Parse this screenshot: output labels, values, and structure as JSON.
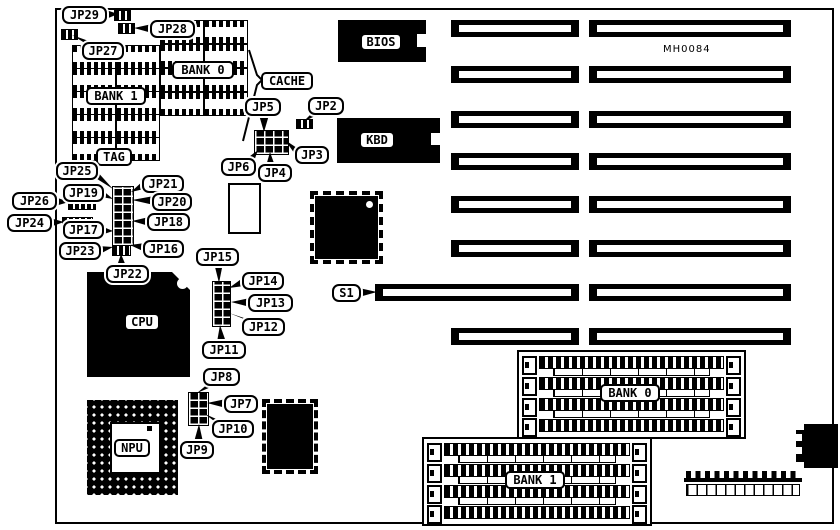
{
  "figure": {
    "kind": "motherboard jumper location diagram",
    "board_code": "MH0084"
  },
  "components": {
    "bios": "BIOS",
    "kbd": "KBD",
    "cpu": "CPU",
    "npu": "NPU",
    "tag": "TAG",
    "cache": "CACHE",
    "cache_bank0": "BANK 0",
    "cache_bank1": "BANK 1",
    "simm_bank0": "BANK 0",
    "simm_bank1": "BANK 1"
  },
  "callouts": {
    "jp2": "JP2",
    "jp3": "JP3",
    "jp4": "JP4",
    "jp5": "JP5",
    "jp6": "JP6",
    "jp7": "JP7",
    "jp8": "JP8",
    "jp9": "JP9",
    "jp10": "JP10",
    "jp11": "JP11",
    "jp12": "JP12",
    "jp13": "JP13",
    "jp14": "JP14",
    "jp15": "JP15",
    "jp16": "JP16",
    "jp17": "JP17",
    "jp18": "JP18",
    "jp19": "JP19",
    "jp20": "JP20",
    "jp21": "JP21",
    "jp22": "JP22",
    "jp23": "JP23",
    "jp24": "JP24",
    "jp25": "JP25",
    "jp26": "JP26",
    "jp27": "JP27",
    "jp28": "JP28",
    "jp29": "JP29",
    "s1": "S1"
  },
  "colors": {
    "ink": "#000000",
    "paper": "#ffffff"
  }
}
